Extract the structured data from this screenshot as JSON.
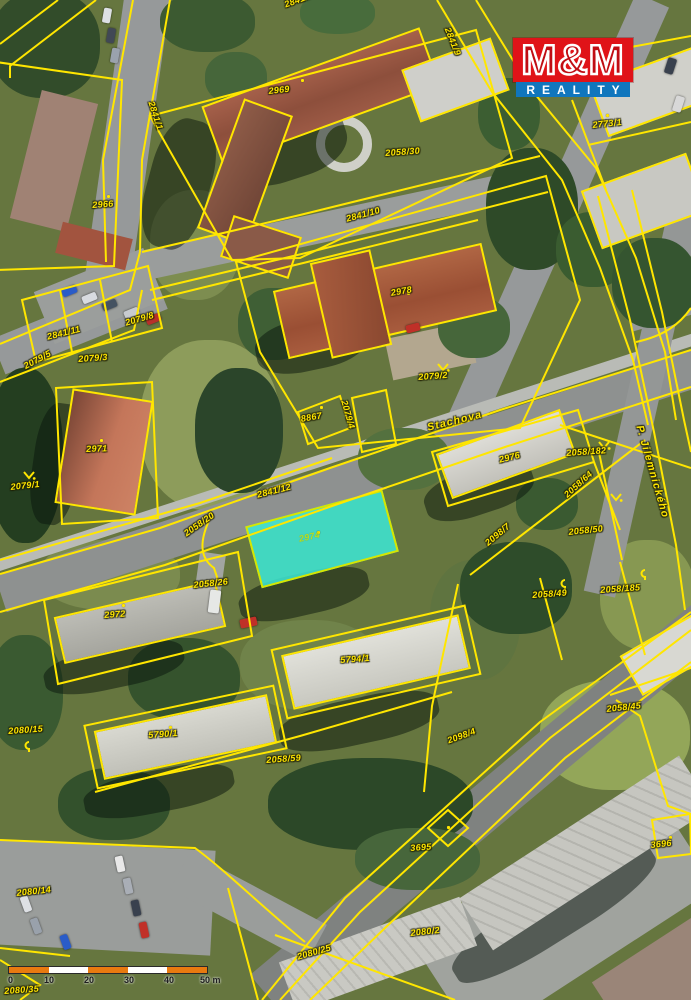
{
  "map": {
    "line_color": "#ffe600",
    "highlight_color": "#3ce9d7",
    "labels": [
      {
        "text": "2841/9",
        "x": 283,
        "y": 0,
        "rot": -20,
        "kind": "parcel"
      },
      {
        "text": "2841/9",
        "x": 452,
        "y": 26,
        "rot": 68,
        "kind": "parcel"
      },
      {
        "text": "2969",
        "x": 268,
        "y": 86,
        "rot": -6,
        "kind": "parcel"
      },
      {
        "text": "2058/30",
        "x": 385,
        "y": 148,
        "rot": -4,
        "kind": "parcel"
      },
      {
        "text": "2773/1",
        "x": 592,
        "y": 120,
        "rot": -6,
        "kind": "parcel"
      },
      {
        "text": "2841/1",
        "x": 156,
        "y": 100,
        "rot": 72,
        "kind": "parcel"
      },
      {
        "text": "2966",
        "x": 92,
        "y": 200,
        "rot": -4,
        "kind": "parcel"
      },
      {
        "text": "2841/10",
        "x": 345,
        "y": 214,
        "rot": -15,
        "kind": "parcel"
      },
      {
        "text": "2978",
        "x": 390,
        "y": 288,
        "rot": -10,
        "kind": "parcel"
      },
      {
        "text": "2079/2",
        "x": 418,
        "y": 372,
        "rot": -4,
        "kind": "parcel"
      },
      {
        "text": "8867",
        "x": 300,
        "y": 414,
        "rot": -10,
        "kind": "parcel"
      },
      {
        "text": "2079/4",
        "x": 349,
        "y": 399,
        "rot": 74,
        "kind": "parcel"
      },
      {
        "text": "2079/8",
        "x": 124,
        "y": 318,
        "rot": -16,
        "kind": "parcel"
      },
      {
        "text": "2841/11",
        "x": 46,
        "y": 332,
        "rot": -14,
        "kind": "parcel"
      },
      {
        "text": "2079/3",
        "x": 78,
        "y": 354,
        "rot": -4,
        "kind": "parcel"
      },
      {
        "text": "2079/5",
        "x": 22,
        "y": 362,
        "rot": -28,
        "kind": "parcel"
      },
      {
        "text": "2971",
        "x": 86,
        "y": 444,
        "rot": -2,
        "kind": "parcel"
      },
      {
        "text": "2079/1",
        "x": 10,
        "y": 482,
        "rot": -6,
        "kind": "parcel"
      },
      {
        "text": "Stachova",
        "x": 426,
        "y": 422,
        "rot": -14,
        "kind": "street"
      },
      {
        "text": "2976",
        "x": 498,
        "y": 455,
        "rot": -14,
        "kind": "parcel"
      },
      {
        "text": "2058/182",
        "x": 566,
        "y": 448,
        "rot": -4,
        "kind": "parcel"
      },
      {
        "text": "2058/64",
        "x": 562,
        "y": 492,
        "rot": -42,
        "kind": "parcel"
      },
      {
        "text": "2058/50",
        "x": 568,
        "y": 527,
        "rot": -6,
        "kind": "parcel"
      },
      {
        "text": "2098/7",
        "x": 483,
        "y": 540,
        "rot": -40,
        "kind": "parcel"
      },
      {
        "text": "2058/49",
        "x": 532,
        "y": 590,
        "rot": -4,
        "kind": "parcel"
      },
      {
        "text": "2058/185",
        "x": 600,
        "y": 585,
        "rot": -4,
        "kind": "parcel"
      },
      {
        "text": "P. Jilemnického",
        "x": 645,
        "y": 424,
        "rot": 74,
        "kind": "street"
      },
      {
        "text": "2841/12",
        "x": 256,
        "y": 490,
        "rot": -14,
        "kind": "parcel"
      },
      {
        "text": "2058/20",
        "x": 182,
        "y": 530,
        "rot": -35,
        "kind": "parcel"
      },
      {
        "text": "2058/26",
        "x": 193,
        "y": 580,
        "rot": -6,
        "kind": "parcel"
      },
      {
        "text": "2974",
        "x": 298,
        "y": 534,
        "rot": -12,
        "kind": "highlight"
      },
      {
        "text": "2972",
        "x": 104,
        "y": 610,
        "rot": -4,
        "kind": "parcel"
      },
      {
        "text": "5794/1",
        "x": 340,
        "y": 655,
        "rot": -4,
        "kind": "parcel"
      },
      {
        "text": "2080/15",
        "x": 8,
        "y": 726,
        "rot": -4,
        "kind": "parcel"
      },
      {
        "text": "5790/1",
        "x": 148,
        "y": 730,
        "rot": -4,
        "kind": "parcel"
      },
      {
        "text": "2058/59",
        "x": 266,
        "y": 755,
        "rot": -4,
        "kind": "parcel"
      },
      {
        "text": "2058/45",
        "x": 606,
        "y": 704,
        "rot": -6,
        "kind": "parcel"
      },
      {
        "text": "2098/4",
        "x": 446,
        "y": 736,
        "rot": -20,
        "kind": "parcel"
      },
      {
        "text": "3695",
        "x": 410,
        "y": 843,
        "rot": -4,
        "kind": "parcel"
      },
      {
        "text": "3696",
        "x": 650,
        "y": 840,
        "rot": -6,
        "kind": "parcel"
      },
      {
        "text": "2080/14",
        "x": 16,
        "y": 888,
        "rot": -6,
        "kind": "parcel"
      },
      {
        "text": "2080/25",
        "x": 296,
        "y": 952,
        "rot": -16,
        "kind": "parcel"
      },
      {
        "text": "2080/2",
        "x": 410,
        "y": 928,
        "rot": -6,
        "kind": "parcel"
      },
      {
        "text": "2080/35",
        "x": 4,
        "y": 986,
        "rot": -4,
        "kind": "parcel"
      }
    ],
    "symbols": [
      {
        "type": "conifer",
        "x": 437,
        "y": 360
      },
      {
        "type": "conifer",
        "x": 598,
        "y": 438
      },
      {
        "type": "conifer",
        "x": 610,
        "y": 490
      },
      {
        "type": "conifer",
        "x": 23,
        "y": 468
      },
      {
        "type": "hook",
        "x": 560,
        "y": 578
      },
      {
        "type": "hook",
        "x": 640,
        "y": 568
      },
      {
        "type": "hook",
        "x": 24,
        "y": 740
      }
    ],
    "dots": [
      {
        "x": 301,
        "y": 79
      },
      {
        "x": 107,
        "y": 195
      },
      {
        "x": 407,
        "y": 292
      },
      {
        "x": 100,
        "y": 439
      },
      {
        "x": 514,
        "y": 452
      },
      {
        "x": 317,
        "y": 531
      },
      {
        "x": 122,
        "y": 604
      },
      {
        "x": 363,
        "y": 654
      },
      {
        "x": 169,
        "y": 726
      },
      {
        "x": 606,
        "y": 114
      },
      {
        "x": 447,
        "y": 826
      },
      {
        "x": 669,
        "y": 836
      },
      {
        "x": 320,
        "y": 406
      }
    ]
  },
  "logo": {
    "line1": "M&M",
    "line2": "REALITY",
    "red": "#e01318",
    "blue": "#1076bd"
  },
  "scalebar": {
    "segment_colors": [
      "#e87a10",
      "#ffffff",
      "#e87a10",
      "#ffffff",
      "#e87a10"
    ],
    "ticks": [
      {
        "label": "0",
        "x": 0
      },
      {
        "label": "10",
        "x": 36
      },
      {
        "label": "20",
        "x": 76
      },
      {
        "label": "30",
        "x": 116
      },
      {
        "label": "40",
        "x": 156
      },
      {
        "label": "50 m",
        "x": 192
      }
    ]
  }
}
